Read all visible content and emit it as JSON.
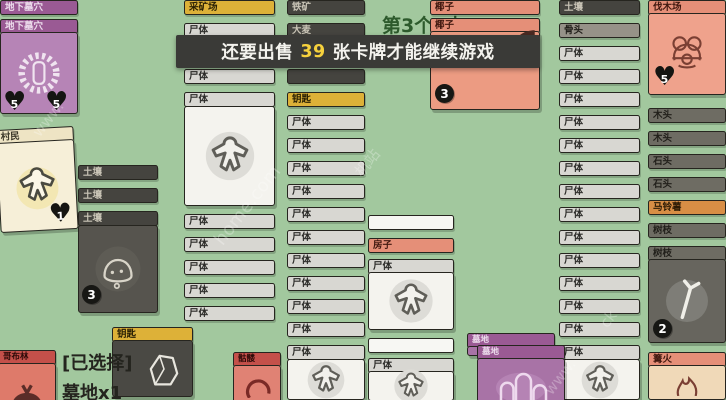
{
  "banner": {
    "prefix": "还要出售",
    "count": "39",
    "suffix": "张卡牌才能继续游戏"
  },
  "quest_text": "第3个“木",
  "selection": {
    "line1": "[已选择]",
    "line2": "墓地x1"
  },
  "labels": {
    "corpse": "尸体"
  },
  "palette": {
    "background": "#a2c89e",
    "banner_bg": "#3a3a37",
    "banner_number": "#f6d13d",
    "corpse_header": "#d8d7d2",
    "dark_header": "#45443f",
    "wood_header": "#6e6c63",
    "bone_header": "#969288",
    "yellow_header": "#ddb138",
    "salmon_header": "#e58f78",
    "potato_header": "#d88e45",
    "purple_header": "#9a5a94",
    "red_header": "#c4504a",
    "cream_header": "#eee4c4"
  },
  "stacks": {
    "catacombs": {
      "label": "地下墓穴",
      "hearts": [
        "5",
        "5"
      ]
    },
    "villager": {
      "label": "村民",
      "heart": "1"
    },
    "soil": {
      "rows": [
        {
          "label": "土壤",
          "t": "dark"
        },
        {
          "label": "土壤",
          "t": "dark"
        },
        {
          "label": "土壤",
          "t": "dark"
        }
      ],
      "count": "3"
    },
    "goblin": {
      "label": "哥布林"
    },
    "key_card": {
      "label": "钥匙"
    },
    "skull": {
      "label": "骷髅"
    },
    "graveyard": {
      "label": "墓地"
    },
    "colA": {
      "rows_top": [
        {
          "label": "采矿场",
          "t": "yellow"
        },
        {
          "label": "尸体",
          "t": "corpse"
        },
        {
          "label": "尸体",
          "t": "corpse"
        },
        {
          "label": "尸体",
          "t": "corpse"
        },
        {
          "label": "尸体",
          "t": "corpse"
        }
      ],
      "rows_bottom": [
        {
          "label": "尸体",
          "t": "corpse"
        },
        {
          "label": "尸体",
          "t": "corpse"
        },
        {
          "label": "尸体",
          "t": "corpse"
        },
        {
          "label": "尸体",
          "t": "corpse"
        },
        {
          "label": "尸体",
          "t": "corpse"
        }
      ]
    },
    "colB": {
      "rows": [
        {
          "label": "铁矿",
          "t": "dark"
        },
        {
          "label": "大麦",
          "t": "dark"
        },
        {
          "label": "",
          "t": "dark"
        },
        {
          "label": "",
          "t": "dark"
        },
        {
          "label": "钥匙",
          "t": "yellow"
        },
        {
          "label": "尸体",
          "t": "corpse"
        },
        {
          "label": "尸体",
          "t": "corpse"
        },
        {
          "label": "尸体",
          "t": "corpse"
        },
        {
          "label": "尸体",
          "t": "corpse"
        },
        {
          "label": "尸体",
          "t": "corpse"
        },
        {
          "label": "尸体",
          "t": "corpse"
        },
        {
          "label": "尸体",
          "t": "corpse"
        },
        {
          "label": "尸体",
          "t": "corpse"
        },
        {
          "label": "尸体",
          "t": "corpse"
        },
        {
          "label": "尸体",
          "t": "corpse"
        },
        {
          "label": "尸体",
          "t": "corpse"
        }
      ]
    },
    "house": {
      "label": "房子",
      "corpse": "尸体"
    },
    "coconut": {
      "rows": [
        {
          "label": "椰子",
          "t": "salmon"
        },
        {
          "label": "椰子",
          "t": "salmon"
        }
      ],
      "count": "3"
    },
    "colD": {
      "rows": [
        {
          "label": "土壤",
          "t": "dark"
        },
        {
          "label": "骨头",
          "t": "bone"
        },
        {
          "label": "尸体",
          "t": "corpse"
        },
        {
          "label": "尸体",
          "t": "corpse"
        },
        {
          "label": "尸体",
          "t": "corpse"
        },
        {
          "label": "尸体",
          "t": "corpse"
        },
        {
          "label": "尸体",
          "t": "corpse"
        },
        {
          "label": "尸体",
          "t": "corpse"
        },
        {
          "label": "尸体",
          "t": "corpse"
        },
        {
          "label": "尸体",
          "t": "corpse"
        },
        {
          "label": "尸体",
          "t": "corpse"
        },
        {
          "label": "尸体",
          "t": "corpse"
        },
        {
          "label": "尸体",
          "t": "corpse"
        },
        {
          "label": "尸体",
          "t": "corpse"
        },
        {
          "label": "尸体",
          "t": "corpse"
        },
        {
          "label": "尸体",
          "t": "corpse"
        }
      ]
    },
    "colE": {
      "lumber": {
        "label": "伐木场",
        "heart": "5"
      },
      "rows": [
        {
          "label": "木头",
          "t": "wood"
        },
        {
          "label": "木头",
          "t": "wood"
        },
        {
          "label": "石头",
          "t": "wood"
        },
        {
          "label": "石头",
          "t": "wood"
        },
        {
          "label": "马铃薯",
          "t": "potato"
        },
        {
          "label": "树枝",
          "t": "wood"
        }
      ],
      "branch": {
        "label": "树枝",
        "count": "2"
      },
      "campfire": {
        "label": "篝火"
      }
    }
  },
  "watermarks": {
    "w1": "www.",
    "w2": "home.com",
    "w3": "机站",
    "w4": "www.",
    "w5": "ck"
  }
}
